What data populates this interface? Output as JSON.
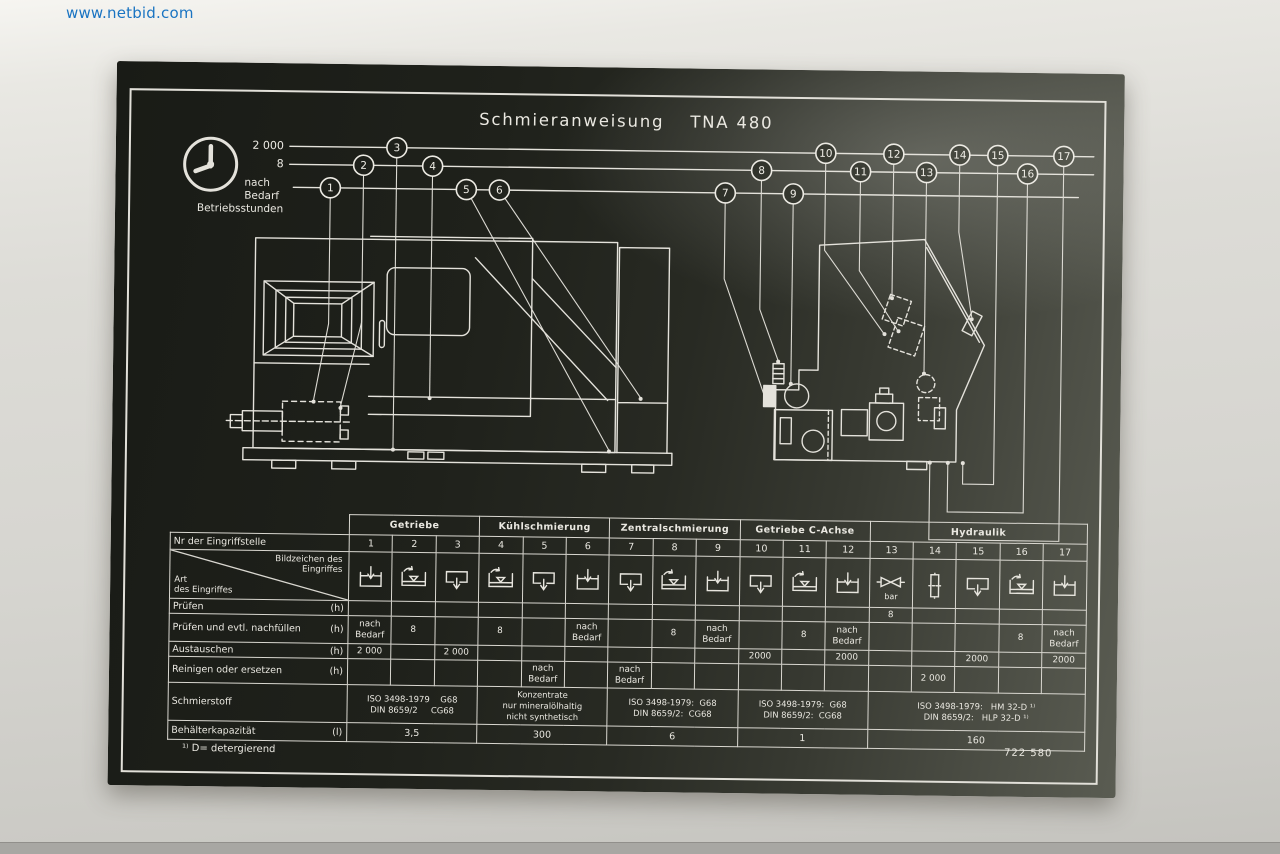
{
  "photo": {
    "watermark": "www.netbid.com"
  },
  "plate": {
    "title_left": "Schmieranweisung",
    "title_right": "TNA 480",
    "legend": {
      "h2000": "2 000",
      "h8": "8",
      "nach": "nach",
      "bedarf": "Bedarf",
      "caption": "Betriebsstunden"
    },
    "callouts": [
      "1",
      "2",
      "3",
      "4",
      "5",
      "6",
      "7",
      "8",
      "9",
      "10",
      "11",
      "12",
      "13",
      "14",
      "15",
      "16",
      "17"
    ],
    "footnote": "¹⁾ D= detergierend",
    "part_number": "722 580"
  },
  "colors": {
    "plate_dark": "#1b1d18",
    "engraving": "#eae8e1",
    "watermark_blue": "#1a74c2"
  },
  "table": {
    "groups": [
      "Getriebe",
      "Kühlschmierung",
      "Zentralschmierung",
      "Getriebe C-Achse",
      "Hydraulik"
    ],
    "nr_label": "Nr der Eingriffstelle",
    "nr": [
      "1",
      "2",
      "3",
      "4",
      "5",
      "6",
      "7",
      "8",
      "9",
      "10",
      "11",
      "12",
      "13",
      "14",
      "15",
      "16",
      "17"
    ],
    "corner": {
      "top1": "Bildzeichen des",
      "top2": "Eingriffes",
      "left1": "Art",
      "left2": "des Eingriffes"
    },
    "symbols": [
      "fill",
      "level",
      "drain",
      "level",
      "drain",
      "fill",
      "drain",
      "level",
      "fill",
      "drain",
      "level",
      "fill",
      "pressure",
      "filter",
      "drain",
      "level",
      "fill"
    ],
    "pressure_unit": "bar",
    "rows": [
      {
        "label": "Prüfen",
        "unit": "(h)",
        "cells": [
          "",
          "",
          "",
          "",
          "",
          "",
          "",
          "",
          "",
          "",
          "",
          "",
          "8",
          "",
          "",
          "",
          ""
        ]
      },
      {
        "label": "Prüfen und evtl. nachfüllen",
        "unit": "(h)",
        "cells": [
          "nach\nBedarf",
          "8",
          "",
          "8",
          "",
          "nach\nBedarf",
          "",
          "8",
          "nach\nBedarf",
          "",
          "8",
          "nach\nBedarf",
          "",
          "",
          "",
          "8",
          "nach\nBedarf"
        ]
      },
      {
        "label": "Austauschen",
        "unit": "(h)",
        "cells": [
          "2 000",
          "",
          "2 000",
          "",
          "",
          "",
          "",
          "",
          "",
          "2000",
          "",
          "2000",
          "",
          "",
          "2000",
          "",
          "2000"
        ]
      },
      {
        "label": "Reinigen oder ersetzen",
        "unit": "(h)",
        "cells": [
          "",
          "",
          "",
          "",
          "nach\nBedarf",
          "",
          "nach\nBedarf",
          "",
          "",
          "",
          "",
          "",
          "",
          "2 000",
          "",
          "",
          ""
        ]
      }
    ],
    "lubricant": {
      "label": "Schmierstoff",
      "cells": [
        "ISO 3498-1979    G68\nDIN 8659/2     CG68",
        "Konzentrate\nnur mineralölhaltig\nnicht synthetisch",
        "ISO 3498-1979:  G68\nDIN 8659/2:  CG68",
        "ISO 3498-1979:  G68\nDIN 8659/2:  CG68",
        "ISO 3498-1979:   HM 32-D ¹⁾\nDIN 8659/2:   HLP 32-D ¹⁾"
      ]
    },
    "capacity": {
      "label": "Behälterkapazität",
      "unit": "(l)",
      "cells": [
        "3,5",
        "300",
        "6",
        "1",
        "160"
      ]
    }
  }
}
